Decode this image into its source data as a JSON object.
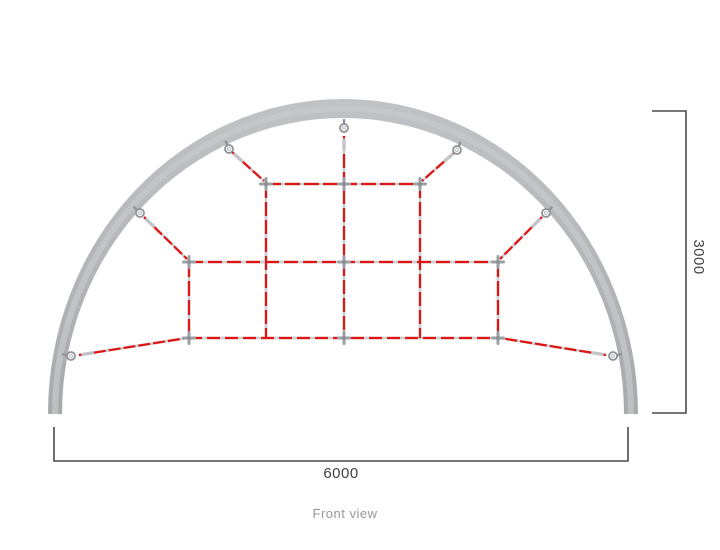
{
  "caption": "Front view",
  "dimensions": {
    "width_label": "6000",
    "height_label": "3000"
  },
  "colors": {
    "rope": "#e11414",
    "rope_base": "#cdd0d3",
    "ferrule": "#c2c5c8",
    "frame": "#b5b7ba",
    "frame_highlight": "#c7c9cc",
    "connector": "#9aa0a5",
    "connector_center": "#8d9195",
    "shackle": "#8e9296",
    "dimension_line": "#4a4a4d",
    "dimension_text": "#3f3f42",
    "caption_text": "#96989b"
  },
  "diagram": {
    "arch": {
      "cx": 343,
      "base_y": 414,
      "outer_rx": 295,
      "outer_ry": 315,
      "inner_rx": 281,
      "inner_ry": 296
    },
    "ropes": [
      {
        "x1": 232,
        "y1": 152,
        "x2": 264,
        "y2": 181,
        "dash": "11 3",
        "ferrule": true
      },
      {
        "x1": 455,
        "y1": 152,
        "x2": 422,
        "y2": 181,
        "dash": "11 3",
        "ferrule": true
      },
      {
        "x1": 144,
        "y1": 217,
        "x2": 187,
        "y2": 259,
        "dash": "11 3",
        "ferrule": true
      },
      {
        "x1": 542,
        "y1": 217,
        "x2": 500,
        "y2": 259,
        "dash": "11 3",
        "ferrule": true
      },
      {
        "x1": 79,
        "y1": 355,
        "x2": 187,
        "y2": 338,
        "dash": "12 3",
        "ferrule": true
      },
      {
        "x1": 606,
        "y1": 355,
        "x2": 500,
        "y2": 338,
        "dash": "12 3",
        "ferrule": true
      },
      {
        "x1": 344,
        "y1": 136,
        "x2": 344,
        "y2": 338,
        "dash": "14 4",
        "ferrule": true
      },
      {
        "x1": 266,
        "y1": 184,
        "x2": 420,
        "y2": 184,
        "dash": "15 4",
        "ferrule": false
      },
      {
        "x1": 189,
        "y1": 262,
        "x2": 498,
        "y2": 262,
        "dash": "14 5",
        "ferrule": false
      },
      {
        "x1": 189,
        "y1": 338,
        "x2": 498,
        "y2": 338,
        "dash": "13 5",
        "ferrule": false
      },
      {
        "x1": 266,
        "y1": 184,
        "x2": 266,
        "y2": 338,
        "dash": "14 4",
        "ferrule": false
      },
      {
        "x1": 420,
        "y1": 184,
        "x2": 420,
        "y2": 338,
        "dash": "14 4",
        "ferrule": false
      },
      {
        "x1": 189,
        "y1": 262,
        "x2": 189,
        "y2": 338,
        "dash": "15 4",
        "ferrule": false
      },
      {
        "x1": 498,
        "y1": 262,
        "x2": 498,
        "y2": 338,
        "dash": "15 4",
        "ferrule": false
      }
    ],
    "connectors": [
      {
        "x": 266,
        "y": 184
      },
      {
        "x": 344,
        "y": 184
      },
      {
        "x": 420,
        "y": 184
      },
      {
        "x": 189,
        "y": 262
      },
      {
        "x": 344,
        "y": 262
      },
      {
        "x": 498,
        "y": 262
      },
      {
        "x": 189,
        "y": 338
      },
      {
        "x": 344,
        "y": 338
      },
      {
        "x": 498,
        "y": 338
      }
    ],
    "anchors": [
      {
        "x": 344,
        "y": 128
      },
      {
        "x": 229,
        "y": 149
      },
      {
        "x": 457,
        "y": 150
      },
      {
        "x": 140,
        "y": 213
      },
      {
        "x": 546,
        "y": 213
      },
      {
        "x": 71,
        "y": 356
      },
      {
        "x": 613,
        "y": 356
      }
    ],
    "dimension_lines": {
      "bottom": {
        "x1": 54,
        "x2": 628,
        "y": 461,
        "tick": 427
      },
      "right": {
        "x": 686,
        "y1": 111,
        "y2": 413,
        "tick": 652
      }
    }
  }
}
